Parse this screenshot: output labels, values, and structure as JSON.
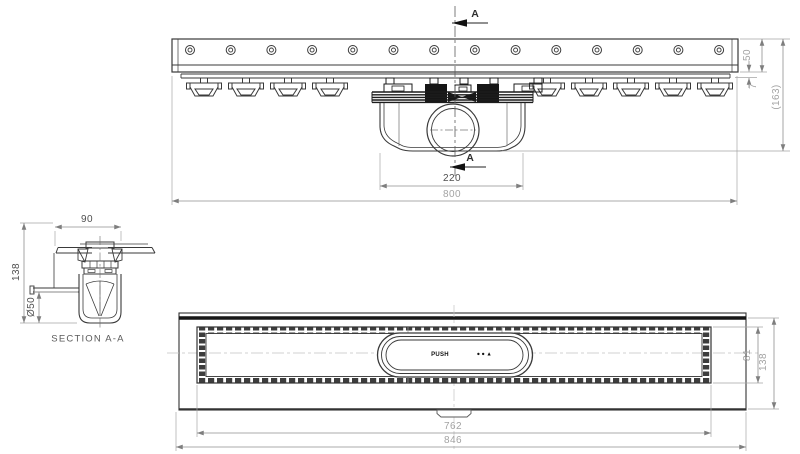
{
  "drawing": {
    "type": "technical-drawing",
    "background": "#ffffff",
    "line_color": "#3a3a3a",
    "dim_color": "#8f8f8f"
  },
  "top_view": {
    "section_arrow_top": "A",
    "section_arrow_bottom": "A",
    "dim_trap_width": "220",
    "dim_channel_length": "800",
    "dim_channel_height": "50",
    "dim_lip_height": "7",
    "dim_total_height": "(163)"
  },
  "section_view": {
    "dim_top_width": "90",
    "dim_total_height": "138",
    "dim_pipe_diameter": "Ø50",
    "title": "SECTION A-A"
  },
  "plan_view": {
    "dim_grate_length": "762",
    "dim_total_length": "846",
    "dim_grate_width": "81",
    "dim_total_width": "138",
    "push_label": "PUSH",
    "push_indicators": "●●▲"
  }
}
